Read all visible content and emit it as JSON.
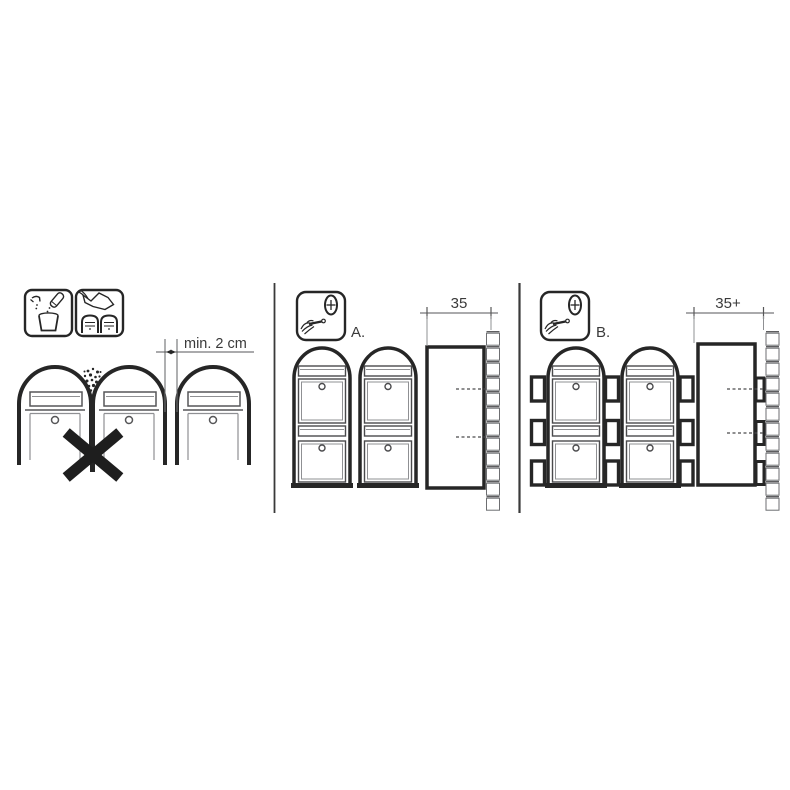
{
  "canvas": {
    "width": 790,
    "height": 790,
    "background": "#ffffff"
  },
  "colors": {
    "line_dark": "#262626",
    "line_medium": "#565658",
    "line_light": "#8f9093",
    "text": "#3a3a3a"
  },
  "left_panel": {
    "icons": [
      {
        "name": "mix-water-icon"
      },
      {
        "name": "wipe-mailbox-icon"
      }
    ],
    "dimension_label": "min. 2 cm",
    "prohibition": "x-mark"
  },
  "panel_a": {
    "label": "A.",
    "icon": "screwdriver-screw-icon",
    "dimension_label": "35"
  },
  "panel_b": {
    "label": "B.",
    "icon": "screwdriver-screw-icon",
    "dimension_label": "35+"
  }
}
